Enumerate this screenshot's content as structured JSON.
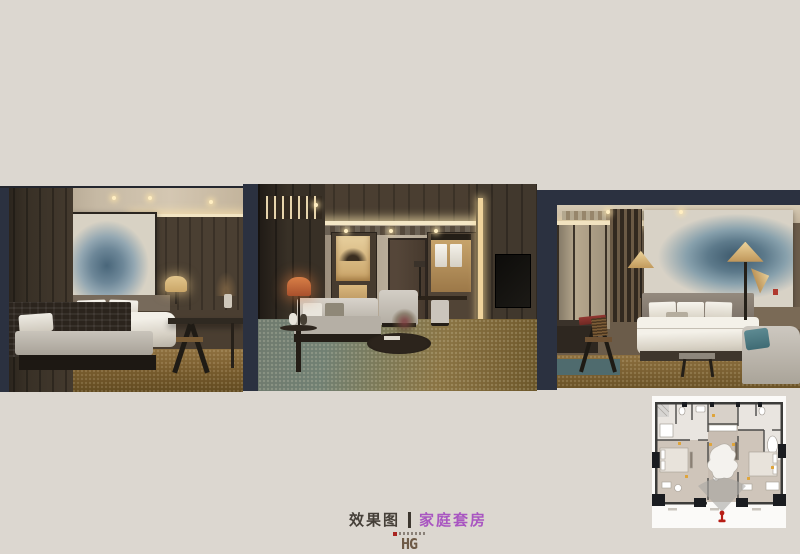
{
  "board": {
    "background_color": "#dcd7d0",
    "frame_color": "#2b3140"
  },
  "caption": {
    "prefix": "效果图",
    "title": "家庭套房",
    "prefix_color": "#453f38",
    "title_color": "#a956c1"
  },
  "logo": {
    "monogram": "HG",
    "color": "#6e5a46",
    "accent_color": "#a92420"
  },
  "renderings": [
    {
      "id": "bedroom-one",
      "subject": "bedroom with ink-wash painting, bed, table lamp, desk chair and slatted daybed"
    },
    {
      "id": "living-room",
      "subject": "living room with wood ceiling, sofa, orange table lamp, coffee table, lit wardrobe and TV wall"
    },
    {
      "id": "bedroom-two",
      "subject": "bedroom with lotus ink painting, cone floor lamps, folding screens, desk and chaise"
    }
  ],
  "floor_plan": {
    "subject": "family-suite floor plan with camera position marker and view cone",
    "wall_color": "#3c3c3a",
    "camera_marker_color": "#b81d15",
    "view_cone_color": "#a8a7a3",
    "light_accent_color": "#dfa439"
  }
}
